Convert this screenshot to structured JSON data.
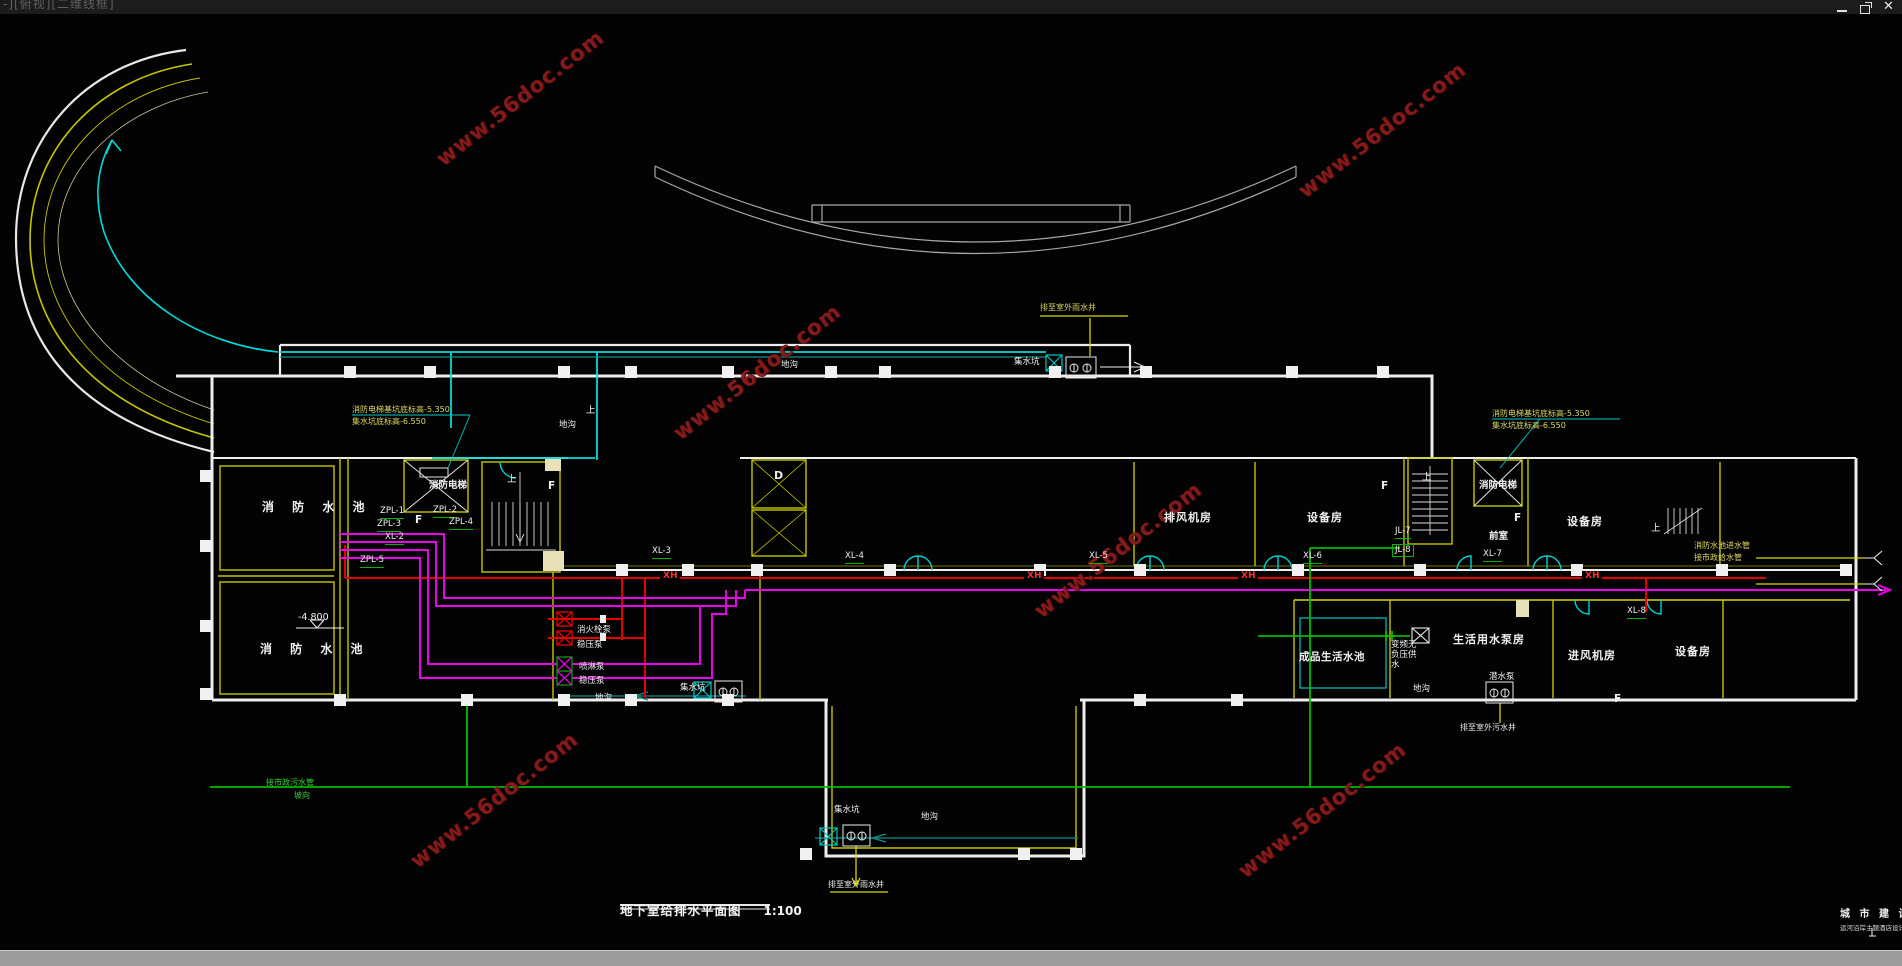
{
  "window": {
    "viewport_label": "-][俯视][二维线框]",
    "controls": {
      "minimize": "最小化",
      "restore": "还原",
      "close": "关闭"
    }
  },
  "title_block": {
    "drawing_title": "地下室给排水平面图",
    "drawing_scale": "1:100",
    "corner_line1": "城 市 建 设",
    "corner_line2": "运河沿岸主题酒店设计大"
  },
  "watermark": {
    "text": "www.56doc.com",
    "color": "#8e1c1c",
    "positions": [
      [
        520,
        98
      ],
      [
        1382,
        130
      ],
      [
        757,
        372
      ],
      [
        1118,
        550
      ],
      [
        494,
        800
      ],
      [
        1322,
        810
      ]
    ]
  },
  "colors": {
    "background": "#030303",
    "wall_white": "#ededed",
    "wall_yellow": "#c6c600",
    "hydrant_main_red": "#e60000",
    "sprinkler_magenta": "#ea00ea",
    "sewer_green": "#00bc00",
    "rainwater_cyan": "#00dcdc",
    "annotation_yellow": "#ddd862",
    "outline_grey": "#a8a8a8"
  },
  "drawing": {
    "labels": [
      {
        "t": "消 防 水 池",
        "x": 262,
        "y": 500,
        "c": "rmsp"
      },
      {
        "t": "消 防 水 池",
        "x": 260,
        "y": 642,
        "c": "rmsp"
      },
      {
        "t": "-4.800",
        "x": 298,
        "y": 612,
        "c": "lv"
      },
      {
        "t": "消防电梯",
        "x": 429,
        "y": 480,
        "c": "sh"
      },
      {
        "t": "消防电梯",
        "x": 1479,
        "y": 480,
        "c": "sh"
      },
      {
        "t": "前室",
        "x": 1489,
        "y": 531,
        "c": "sh"
      },
      {
        "t": "排风机房",
        "x": 1164,
        "y": 511,
        "c": "rm"
      },
      {
        "t": "设备房",
        "x": 1307,
        "y": 511,
        "c": "rm"
      },
      {
        "t": "设备房",
        "x": 1567,
        "y": 515,
        "c": "rm"
      },
      {
        "t": "设备房",
        "x": 1675,
        "y": 645,
        "c": "rm"
      },
      {
        "t": "成品生活水池",
        "x": 1299,
        "y": 651,
        "c": "rm2"
      },
      {
        "t": "生活用水泵房",
        "x": 1453,
        "y": 633,
        "c": "rm"
      },
      {
        "t": "进风机房",
        "x": 1568,
        "y": 649,
        "c": "rm"
      },
      {
        "t": "D",
        "x": 774,
        "y": 469,
        "c": "d"
      },
      {
        "t": "F",
        "x": 415,
        "y": 514,
        "c": "f"
      },
      {
        "t": "F",
        "x": 548,
        "y": 480,
        "c": "f"
      },
      {
        "t": "F",
        "x": 1381,
        "y": 480,
        "c": "f"
      },
      {
        "t": "F",
        "x": 1514,
        "y": 512,
        "c": "f"
      },
      {
        "t": "F",
        "x": 1614,
        "y": 693,
        "c": "f"
      },
      {
        "t": "上",
        "x": 507,
        "y": 474,
        "c": "up"
      },
      {
        "t": "上",
        "x": 586,
        "y": 405,
        "c": "up"
      },
      {
        "t": "上",
        "x": 1422,
        "y": 472,
        "c": "up"
      },
      {
        "t": "上",
        "x": 1651,
        "y": 523,
        "c": "up"
      },
      {
        "t": "ZPL-1",
        "x": 380,
        "y": 506,
        "c": "pl"
      },
      {
        "t": "ZPL-3",
        "x": 377,
        "y": 519,
        "c": "pl"
      },
      {
        "t": "XL-2",
        "x": 385,
        "y": 532,
        "c": "pl"
      },
      {
        "t": "ZPL-5",
        "x": 360,
        "y": 555,
        "c": "pl"
      },
      {
        "t": "ZPL-2",
        "x": 433,
        "y": 505,
        "c": "pl"
      },
      {
        "t": "ZPL-4",
        "x": 449,
        "y": 517,
        "c": "pl"
      },
      {
        "t": "XL-3",
        "x": 652,
        "y": 546,
        "c": "pl"
      },
      {
        "t": "XL-4",
        "x": 845,
        "y": 551,
        "c": "pl"
      },
      {
        "t": "XL-5",
        "x": 1089,
        "y": 551,
        "c": "pl"
      },
      {
        "t": "XL-6",
        "x": 1303,
        "y": 551,
        "c": "pl"
      },
      {
        "t": "XL-7",
        "x": 1483,
        "y": 549,
        "c": "pl"
      },
      {
        "t": "JL-7",
        "x": 1395,
        "y": 526,
        "c": "pl"
      },
      {
        "t": "JL-8",
        "x": 1392,
        "y": 544,
        "c": "plb"
      },
      {
        "t": "XL-8",
        "x": 1627,
        "y": 606,
        "c": "pl"
      },
      {
        "t": "XH",
        "x": 660,
        "y": 571,
        "c": "xh"
      },
      {
        "t": "XH",
        "x": 1024,
        "y": 571,
        "c": "xh"
      },
      {
        "t": "XH",
        "x": 1238,
        "y": 571,
        "c": "xh"
      },
      {
        "t": "XH",
        "x": 1582,
        "y": 571,
        "c": "xh"
      },
      {
        "t": "消火栓泵",
        "x": 577,
        "y": 625,
        "c": "eq"
      },
      {
        "t": "稳压泵",
        "x": 577,
        "y": 640,
        "c": "eq"
      },
      {
        "t": "喷淋泵",
        "x": 579,
        "y": 662,
        "c": "eq"
      },
      {
        "t": "稳压泵",
        "x": 579,
        "y": 676,
        "c": "eq"
      },
      {
        "t": "潜水泵",
        "x": 1489,
        "y": 672,
        "c": "eq"
      },
      {
        "t": "变频无\n负压供\n水",
        "x": 1391,
        "y": 640,
        "c": "eq"
      },
      {
        "t": "集水坑",
        "x": 680,
        "y": 683,
        "c": "tr"
      },
      {
        "t": "集水坑",
        "x": 834,
        "y": 805,
        "c": "tr"
      },
      {
        "t": "集水坑",
        "x": 1014,
        "y": 357,
        "c": "tr"
      },
      {
        "t": "地沟",
        "x": 595,
        "y": 693,
        "c": "tr"
      },
      {
        "t": "地沟",
        "x": 781,
        "y": 360,
        "c": "tr"
      },
      {
        "t": "地沟",
        "x": 559,
        "y": 420,
        "c": "tr"
      },
      {
        "t": "地沟",
        "x": 1413,
        "y": 684,
        "c": "tr"
      },
      {
        "t": "地沟",
        "x": 921,
        "y": 812,
        "c": "tr"
      },
      {
        "t": "消防电梯基坑底标高-5.350\n集水坑底标高-6.550",
        "x": 352,
        "y": 404,
        "c": "ay"
      },
      {
        "t": "消防电梯基坑底标高-5.350\n集水坑底标高-6.550",
        "x": 1492,
        "y": 408,
        "c": "ay"
      },
      {
        "t": "排至室外雨水井",
        "x": 1040,
        "y": 302,
        "c": "ay"
      },
      {
        "t": "消防水池进水管\n接市政给水管",
        "x": 1694,
        "y": 540,
        "c": "ay"
      },
      {
        "t": "排至室外雨水井",
        "x": 828,
        "y": 880,
        "c": "aw"
      },
      {
        "t": "排至室外污水井",
        "x": 1460,
        "y": 723,
        "c": "aw"
      },
      {
        "t": "接市政污水管",
        "x": 266,
        "y": 778,
        "c": "ag"
      },
      {
        "t": "坡向",
        "x": 294,
        "y": 791,
        "c": "ag"
      }
    ]
  }
}
